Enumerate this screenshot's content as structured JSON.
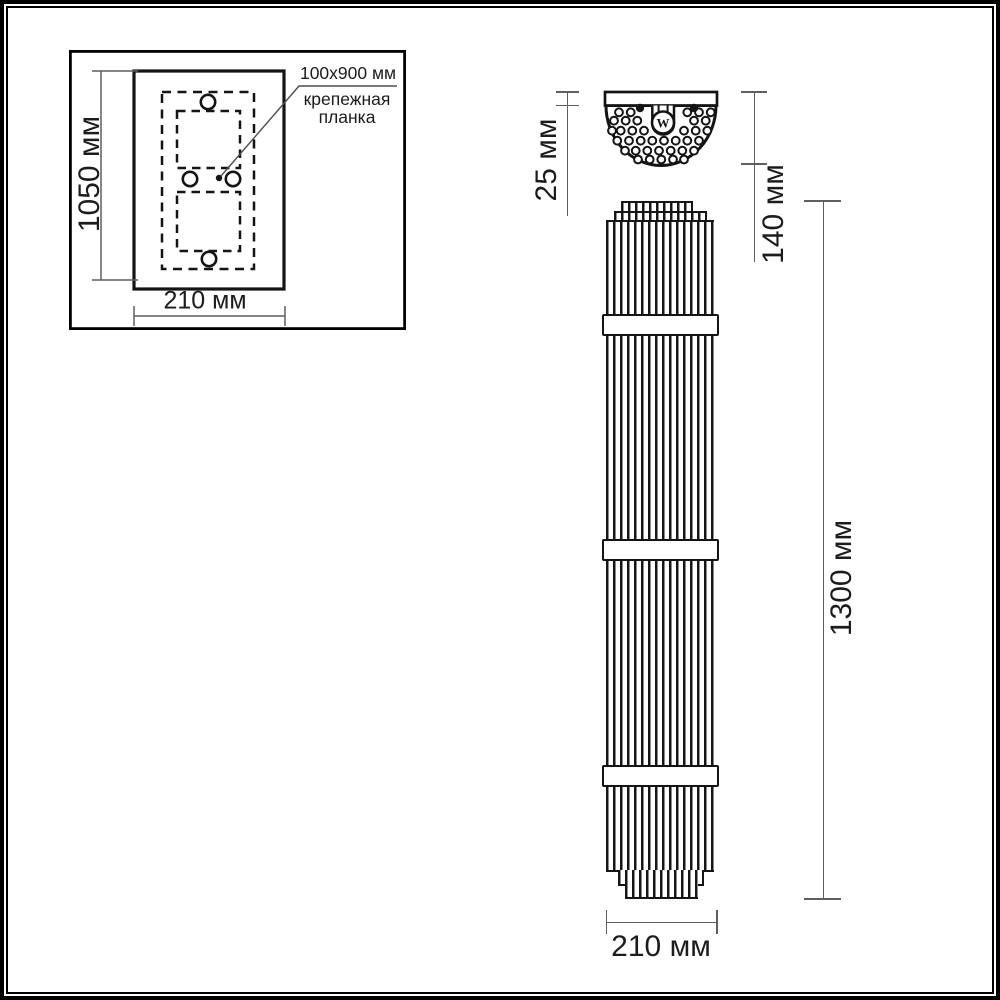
{
  "inset": {
    "height_label": "1050 мм",
    "width_label": "210 мм",
    "callout_line1": "100x900 мм",
    "callout_line2": "крепежная",
    "callout_line3": "планка"
  },
  "lamp": {
    "depth_label": "25 мм",
    "projection_label": "140 мм",
    "height_label": "1300 мм",
    "width_label": "210 мм",
    "emblem_letter": "W"
  },
  "colors": {
    "drawing_line": "#1a1a1a",
    "dimension_line": "#5f5f5f",
    "background": "#ffffff"
  }
}
